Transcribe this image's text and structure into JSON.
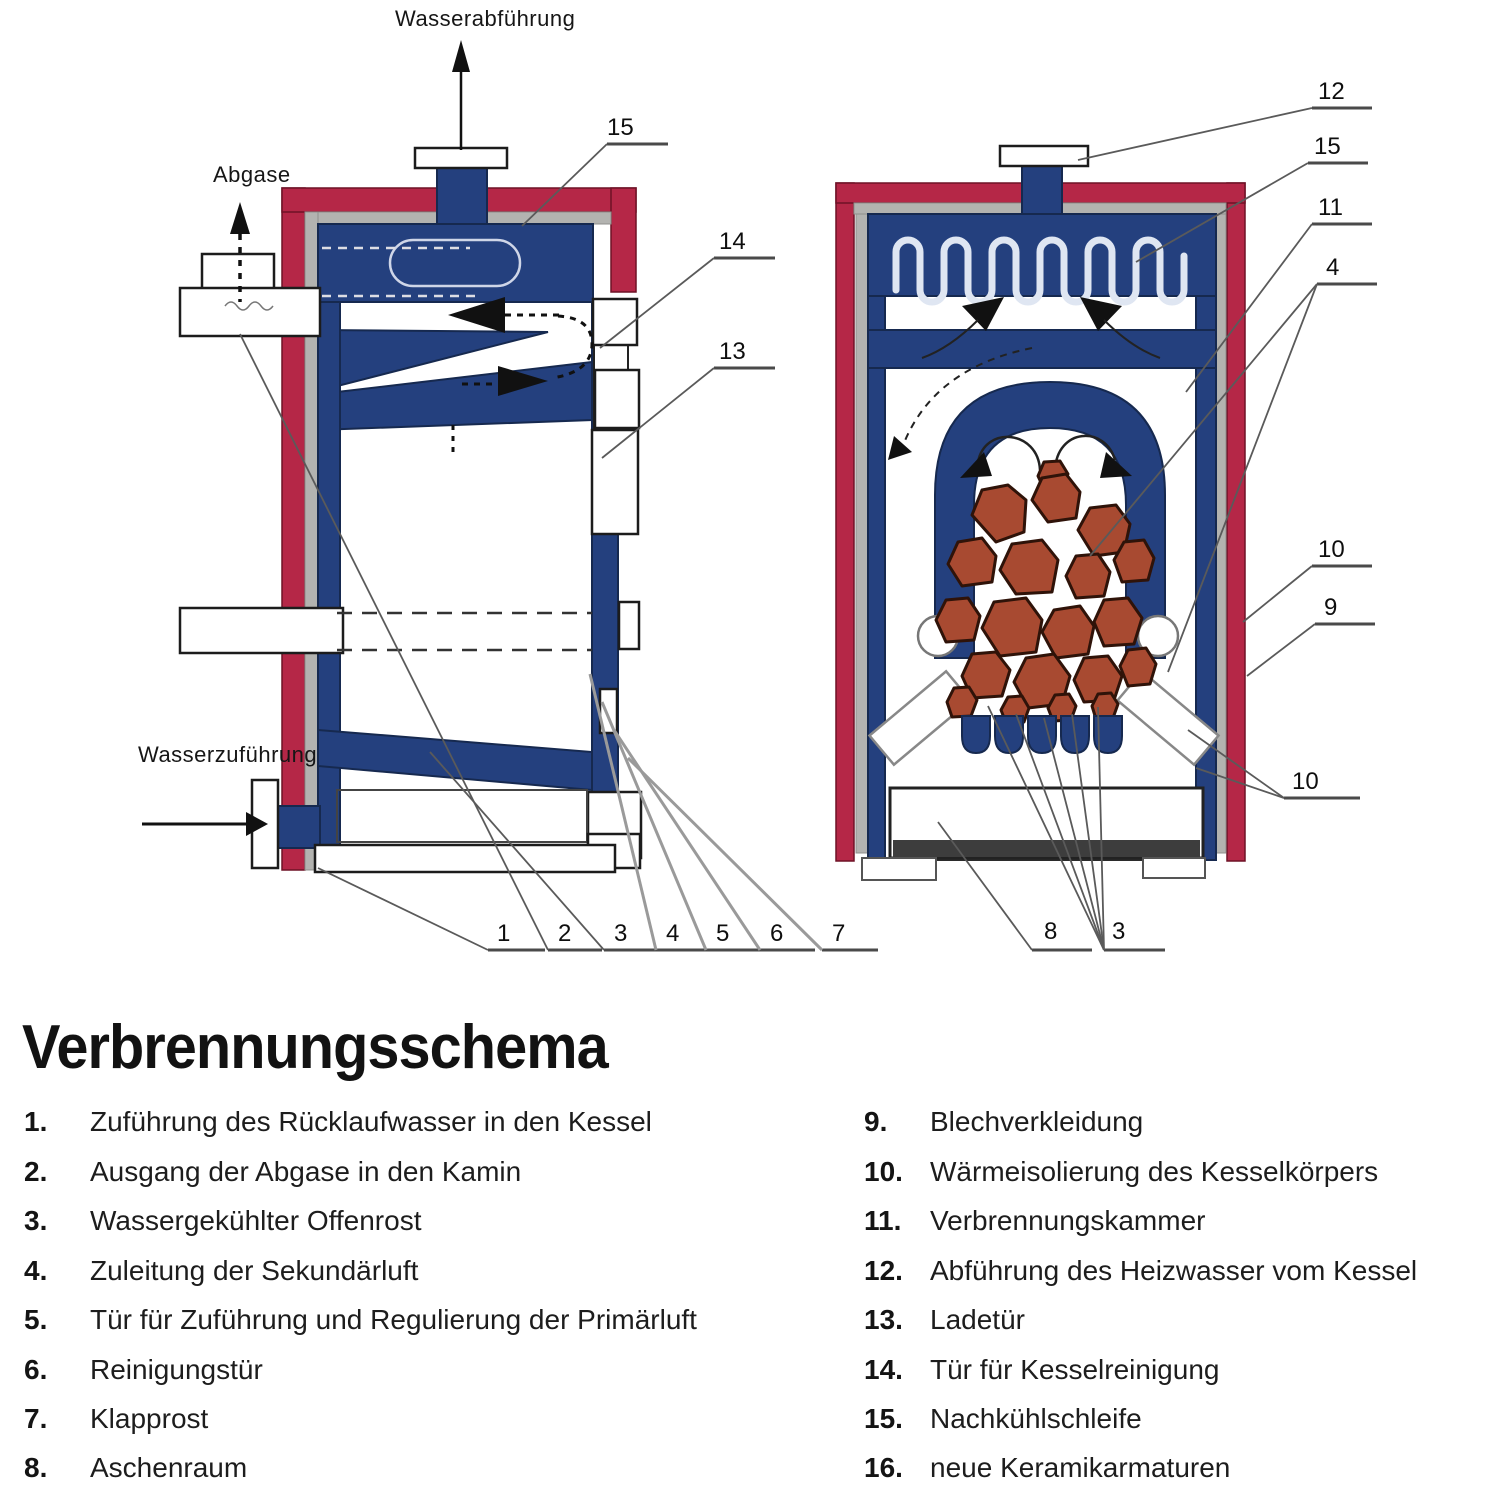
{
  "title": "Verbrennungsschema",
  "diagram": {
    "labels": {
      "water_out": "Wasserabführung",
      "flue_gas": "Abgase",
      "water_in": "Wasserzuführung"
    },
    "callouts": [
      "15",
      "14",
      "13",
      "1",
      "2",
      "3",
      "4",
      "5",
      "6",
      "7",
      "12",
      "15",
      "11",
      "4",
      "10",
      "9",
      "10",
      "8",
      "3"
    ]
  },
  "legend": {
    "left": [
      {
        "num": "1.",
        "text": "Zuführung des Rücklaufwasser in den Kessel"
      },
      {
        "num": "2.",
        "text": "Ausgang der Abgase in den Kamin"
      },
      {
        "num": "3.",
        "text": "Wassergekühlter Offenrost"
      },
      {
        "num": "4.",
        "text": "Zuleitung der Sekundärluft"
      },
      {
        "num": "5.",
        "text": "Tür für Zuführung und Regulierung der Primärluft"
      },
      {
        "num": "6.",
        "text": "Reinigungstür"
      },
      {
        "num": "7.",
        "text": "Klapprost"
      },
      {
        "num": "8.",
        "text": "Aschenraum"
      }
    ],
    "right": [
      {
        "num": "9.",
        "text": "Blechverkleidung"
      },
      {
        "num": "10.",
        "text": "Wärmeisolierung des Kesselkörpers"
      },
      {
        "num": "11.",
        "text": "Verbrennungskammer"
      },
      {
        "num": "12.",
        "text": "Abführung des Heizwasser vom Kessel"
      },
      {
        "num": "13.",
        "text": "Ladetür"
      },
      {
        "num": "14.",
        "text": "Tür für Kesselreinigung"
      },
      {
        "num": "15.",
        "text": "Nachkühlschleife"
      },
      {
        "num": "16.",
        "text": "neue Keramikarmaturen"
      }
    ]
  },
  "colors": {
    "c-red": "#b52747",
    "c-blue": "#24407e",
    "c-gray": "#b3b3b0",
    "c-log": "#a84a31",
    "c-ink": "#121212"
  }
}
